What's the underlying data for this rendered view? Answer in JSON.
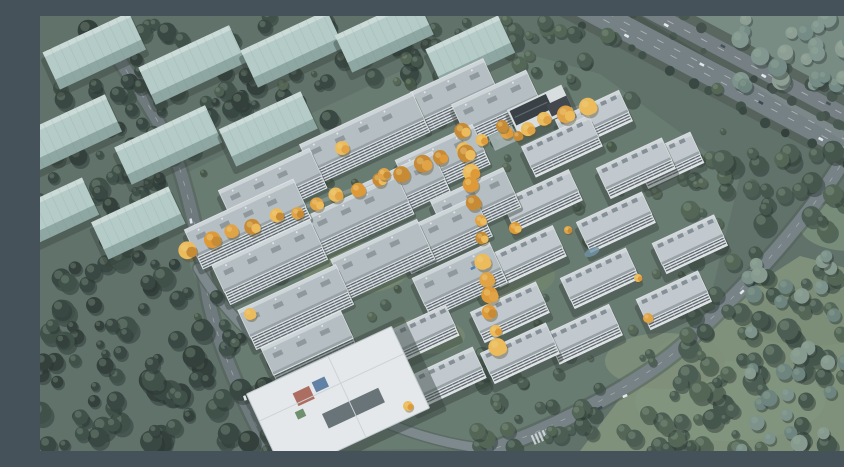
{
  "scene": {
    "type": "aerial-architectural-rendering",
    "subject": "residential-development-masterplan-autumn-dusk",
    "canvas": {
      "w": 844,
      "h": 435
    },
    "rotation_deg": -25,
    "palette": {
      "ground_base": "#5e6e65",
      "site_ground": "#67796d",
      "park_grass": "#7f9077",
      "haze_topright": "#74897f",
      "forest_dark": [
        "#2c3831",
        "#33403a",
        "#3a4a40"
      ],
      "forest_mid": [
        "#3f5045",
        "#47584c",
        "#50614f"
      ],
      "forest_hazy": [
        "#6c837b",
        "#7b9187",
        "#87998c"
      ],
      "forest_inner": [
        "#49594c",
        "#52624f",
        "#43523f"
      ],
      "tree_shadow": "#222d27",
      "tree_highlight": "#9db39c",
      "road_main": "#6d777a",
      "road_secondary": "#757f82",
      "road_path": "#95a09c",
      "road_verge": "#4d5a51",
      "road_median": "#47534b",
      "lane_line": "#ccd3d3",
      "block_face": "#b9cfc9",
      "block_side": "#8fa8a2",
      "block_top": "#d2e0dc",
      "bldg_roof": "#b9c0c4",
      "bldg_roof_top": "#d8dde0",
      "bldg_roof_edge": "#9aa2a6",
      "bldg_face": "#e2e6e8",
      "bldg_stripe": "#4e575e",
      "bldg_shadow": "#2f3a33",
      "roof_unit": "#8f979c",
      "low_roof": "#c7cdd1",
      "low_face": "#e5e8ea",
      "low_dormer": "#79828a",
      "autumn": [
        "#e8a33d",
        "#f3bd55",
        "#cd882b",
        "#e59a2f"
      ],
      "autumn_highlight": "#f6d27c",
      "club_roof": "#34393d",
      "club_ridge": "#5d646a",
      "plaza": "#a7b5b2",
      "kg_roof": "#eceeef",
      "kg_edge": "#c6cbce",
      "kg_court": "#596267",
      "kg_red": "#b06a5c",
      "kg_blue": "#5e7fa3",
      "kg_green": "#6d8f6a",
      "car_white": "#e8ecee",
      "car_dark": "#39424a",
      "car_blue": "#4d7fae",
      "pond": "#6f93a8",
      "haze_overlay": "#8fa3ad"
    },
    "ground": {
      "site_polygon": [
        [
          140,
          160
        ],
        [
          430,
          22
        ],
        [
          560,
          58
        ],
        [
          700,
          160
        ],
        [
          660,
          325
        ],
        [
          450,
          432
        ],
        [
          235,
          435
        ],
        [
          150,
          250
        ]
      ],
      "park_polygon": [
        [
          540,
          435
        ],
        [
          620,
          330
        ],
        [
          760,
          240
        ],
        [
          844,
          262
        ],
        [
          844,
          435
        ]
      ],
      "haze_polygon": [
        [
          600,
          0
        ],
        [
          844,
          0
        ],
        [
          844,
          150
        ]
      ],
      "lawns": [
        [
          315,
          252,
          55,
          26,
          "#74866c"
        ],
        [
          470,
          260,
          45,
          22,
          "#6f8168"
        ],
        [
          385,
          320,
          40,
          18,
          "#74866c"
        ],
        [
          690,
          385,
          95,
          40,
          "#82937a"
        ],
        [
          625,
          345,
          60,
          28,
          "#7d8e75"
        ],
        [
          770,
          300,
          70,
          30,
          "#7b8c73"
        ],
        [
          810,
          210,
          50,
          25,
          "#7a8d78"
        ]
      ]
    },
    "roads": {
      "highway": {
        "cx": 700,
        "cy": 62,
        "angle": 28,
        "half_len": 300,
        "dash_offsets": [
          -16.5,
          5,
          12.5
        ],
        "cars": [
          [
            -265,
            -20,
            0
          ],
          [
            -215,
            -13,
            1
          ],
          [
            -150,
            -19,
            0
          ],
          [
            -90,
            -12,
            0
          ],
          [
            -30,
            -20,
            1
          ],
          [
            20,
            -13,
            0
          ],
          [
            -250,
            4,
            0
          ],
          [
            -190,
            10,
            1
          ],
          [
            -120,
            16,
            0
          ],
          [
            -40,
            6,
            0
          ],
          [
            30,
            12,
            1
          ],
          [
            100,
            16,
            0
          ],
          [
            160,
            5,
            0
          ],
          [
            220,
            11,
            0
          ],
          [
            90,
            -19,
            1
          ],
          [
            170,
            -12,
            0
          ]
        ]
      },
      "ring_road_path": "M 800 150 C 765 205, 715 262, 655 318 C 612 362, 520 410, 448 435",
      "left_road_path": "M 78 42 C 100 75, 130 120, 142 160 C 152 195, 160 228, 168 282 C 178 330, 205 390, 230 435",
      "branch_road_path": "M 158 252 C 185 300, 240 350, 300 385 C 350 412, 400 428, 448 433",
      "axis_path_1": "M 150 233 L 548 88",
      "axis_path_2": "M 424 118 L 458 332",
      "crosswalk": {
        "x": 500,
        "y": 421,
        "angle": -24,
        "stripes": 5
      }
    },
    "context_blocks": [
      [
        52,
        30,
        95
      ],
      [
        150,
        44,
        100
      ],
      [
        250,
        28,
        95
      ],
      [
        342,
        14,
        90
      ],
      [
        428,
        30,
        80
      ],
      [
        28,
        112,
        95
      ],
      [
        126,
        124,
        100
      ],
      [
        226,
        108,
        90
      ],
      [
        12,
        192,
        80
      ],
      [
        96,
        202,
        85
      ]
    ],
    "buildings_large": [
      [
        322,
        116,
        124
      ],
      [
        230,
        167,
        100
      ],
      [
        205,
        202,
        120
      ],
      [
        227,
        240,
        108
      ],
      [
        253,
        285,
        108
      ],
      [
        267,
        327,
        88
      ],
      [
        317,
        193,
        100
      ],
      [
        340,
        237,
        95
      ],
      [
        360,
        167,
        85
      ],
      [
        400,
        213,
        90
      ],
      [
        417,
        258,
        85
      ],
      [
        400,
        140,
        85
      ],
      [
        433,
        182,
        80
      ],
      [
        413,
        73,
        80
      ],
      [
        455,
        85,
        82
      ]
    ],
    "buildings_low": [
      [
        520,
        126,
        74
      ],
      [
        594,
        148,
        72
      ],
      [
        552,
        100,
        70
      ],
      [
        500,
        180,
        74
      ],
      [
        574,
        202,
        72
      ],
      [
        648,
        224,
        68
      ],
      [
        484,
        236,
        74
      ],
      [
        558,
        258,
        72
      ],
      [
        632,
        280,
        68
      ],
      [
        468,
        292,
        72
      ],
      [
        542,
        314,
        70
      ],
      [
        375,
        316,
        78
      ],
      [
        403,
        358,
        76
      ],
      [
        478,
        333,
        72
      ],
      [
        627,
        140,
        62
      ]
    ],
    "clubhouse": {
      "x": 500,
      "y": 94
    },
    "kindergarten": {
      "x": 298,
      "y": 385
    },
    "pond": {
      "x": 552,
      "y": 236
    },
    "autumn_axes": [
      {
        "x1": 150,
        "y1": 233,
        "x2": 548,
        "y2": 88,
        "count": 20
      },
      {
        "x1": 424,
        "y1": 118,
        "x2": 458,
        "y2": 332,
        "count": 13
      }
    ],
    "autumn_clumps": [
      [
        302,
        132,
        7
      ],
      [
        344,
        158,
        6
      ],
      [
        475,
        212,
        6
      ],
      [
        210,
        298,
        6
      ],
      [
        368,
        390,
        5
      ],
      [
        608,
        302,
        5
      ],
      [
        528,
        214,
        4
      ],
      [
        598,
        262,
        4
      ],
      [
        462,
        110,
        6
      ],
      [
        478,
        120,
        5
      ]
    ],
    "forest_zones": [
      {
        "rect": [
          0,
          0,
          130,
          255
        ],
        "count": 50,
        "rmin": 5,
        "rmax": 11,
        "pal": "forest_dark"
      },
      {
        "rect": [
          0,
          225,
          240,
          210
        ],
        "count": 95,
        "rmin": 5,
        "rmax": 12,
        "pal": "forest_dark"
      },
      {
        "rect": [
          95,
          0,
          345,
          135
        ],
        "count": 65,
        "rmin": 4,
        "rmax": 10,
        "pal": "forest_dark"
      },
      {
        "rect": [
          360,
          0,
          240,
          105
        ],
        "count": 40,
        "rmin": 4,
        "rmax": 9,
        "pal": "forest_mid"
      },
      {
        "rect": [
          700,
          0,
          144,
          70
        ],
        "count": 30,
        "rmin": 5,
        "rmax": 10,
        "pal": "forest_hazy"
      },
      {
        "rect": [
          640,
          135,
          204,
          300
        ],
        "count": 115,
        "rmin": 5,
        "rmax": 11,
        "pal": "forest_mid"
      },
      {
        "rect": [
          700,
          230,
          144,
          205
        ],
        "count": 40,
        "rmin": 5,
        "rmax": 9,
        "pal": "forest_hazy"
      },
      {
        "rect": [
          420,
          330,
          280,
          105
        ],
        "count": 55,
        "rmin": 4,
        "rmax": 9,
        "pal": "forest_mid"
      },
      {
        "rect": [
          55,
          60,
          70,
          370
        ],
        "count": 40,
        "rmin": 4,
        "rmax": 8,
        "pal": "forest_dark"
      },
      {
        "rect": [
          145,
          55,
          545,
          305
        ],
        "count": 85,
        "rmin": 3,
        "rmax": 6,
        "pal": "forest_inner"
      }
    ],
    "other_cars": [
      [
        151,
        205,
        80,
        "car_white"
      ],
      [
        186,
        332,
        78,
        "car_dark"
      ],
      [
        205,
        382,
        72,
        "car_white"
      ],
      [
        702,
        276,
        -43,
        "car_white"
      ],
      [
        585,
        380,
        -25,
        "car_white"
      ],
      [
        433,
        252,
        -25,
        "car_blue"
      ],
      [
        560,
        392,
        -25,
        "car_dark"
      ]
    ]
  }
}
